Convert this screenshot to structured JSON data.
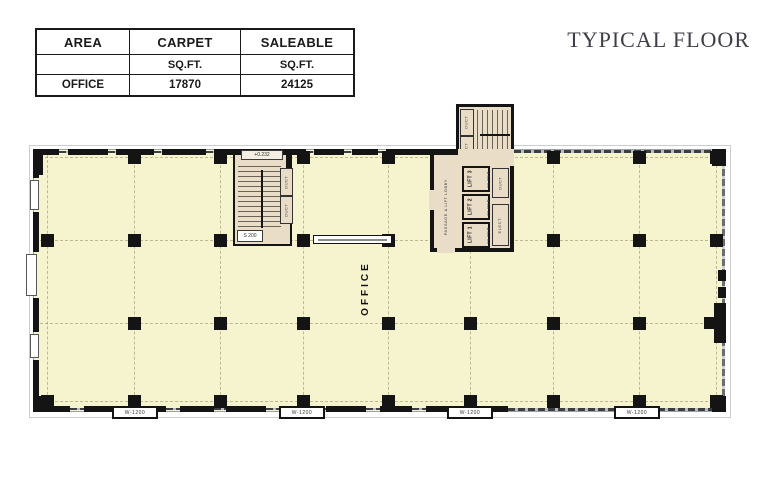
{
  "title": "TYPICAL FLOOR",
  "table": {
    "headers": [
      "AREA",
      "CARPET",
      "SALEABLE"
    ],
    "units_row": [
      "",
      "SQ.FT.",
      "SQ.FT."
    ],
    "rows": [
      [
        "OFFICE",
        "17870",
        "24125"
      ]
    ]
  },
  "plan": {
    "office_label": "OFFICE",
    "core": {
      "lobby_label": "PASSAGE & LIFT LOBBY",
      "lifts": [
        {
          "name": "LIFT 1",
          "capacity": "20 PER."
        },
        {
          "name": "LIFT 2",
          "capacity": "20 PER."
        },
        {
          "name": "LIFT 3",
          "capacity": "20 PER."
        }
      ],
      "shafts": [
        "DUCT",
        "ELECT."
      ],
      "stair_duct_labels": [
        "DUCT",
        "DUCT"
      ]
    },
    "stair_west": {
      "level_label": "+0.232",
      "side_labels": [
        "DUCT",
        "DUCT"
      ],
      "landing_label": "S 200"
    },
    "window_tags": [
      "W-1200",
      "W-1200",
      "W-1200",
      "W-1200"
    ],
    "colors": {
      "floor_fill": "#f6f3cf",
      "core_fill": "#e9ddc7",
      "wall": "#141414",
      "title_text": "#3e3e49"
    }
  }
}
